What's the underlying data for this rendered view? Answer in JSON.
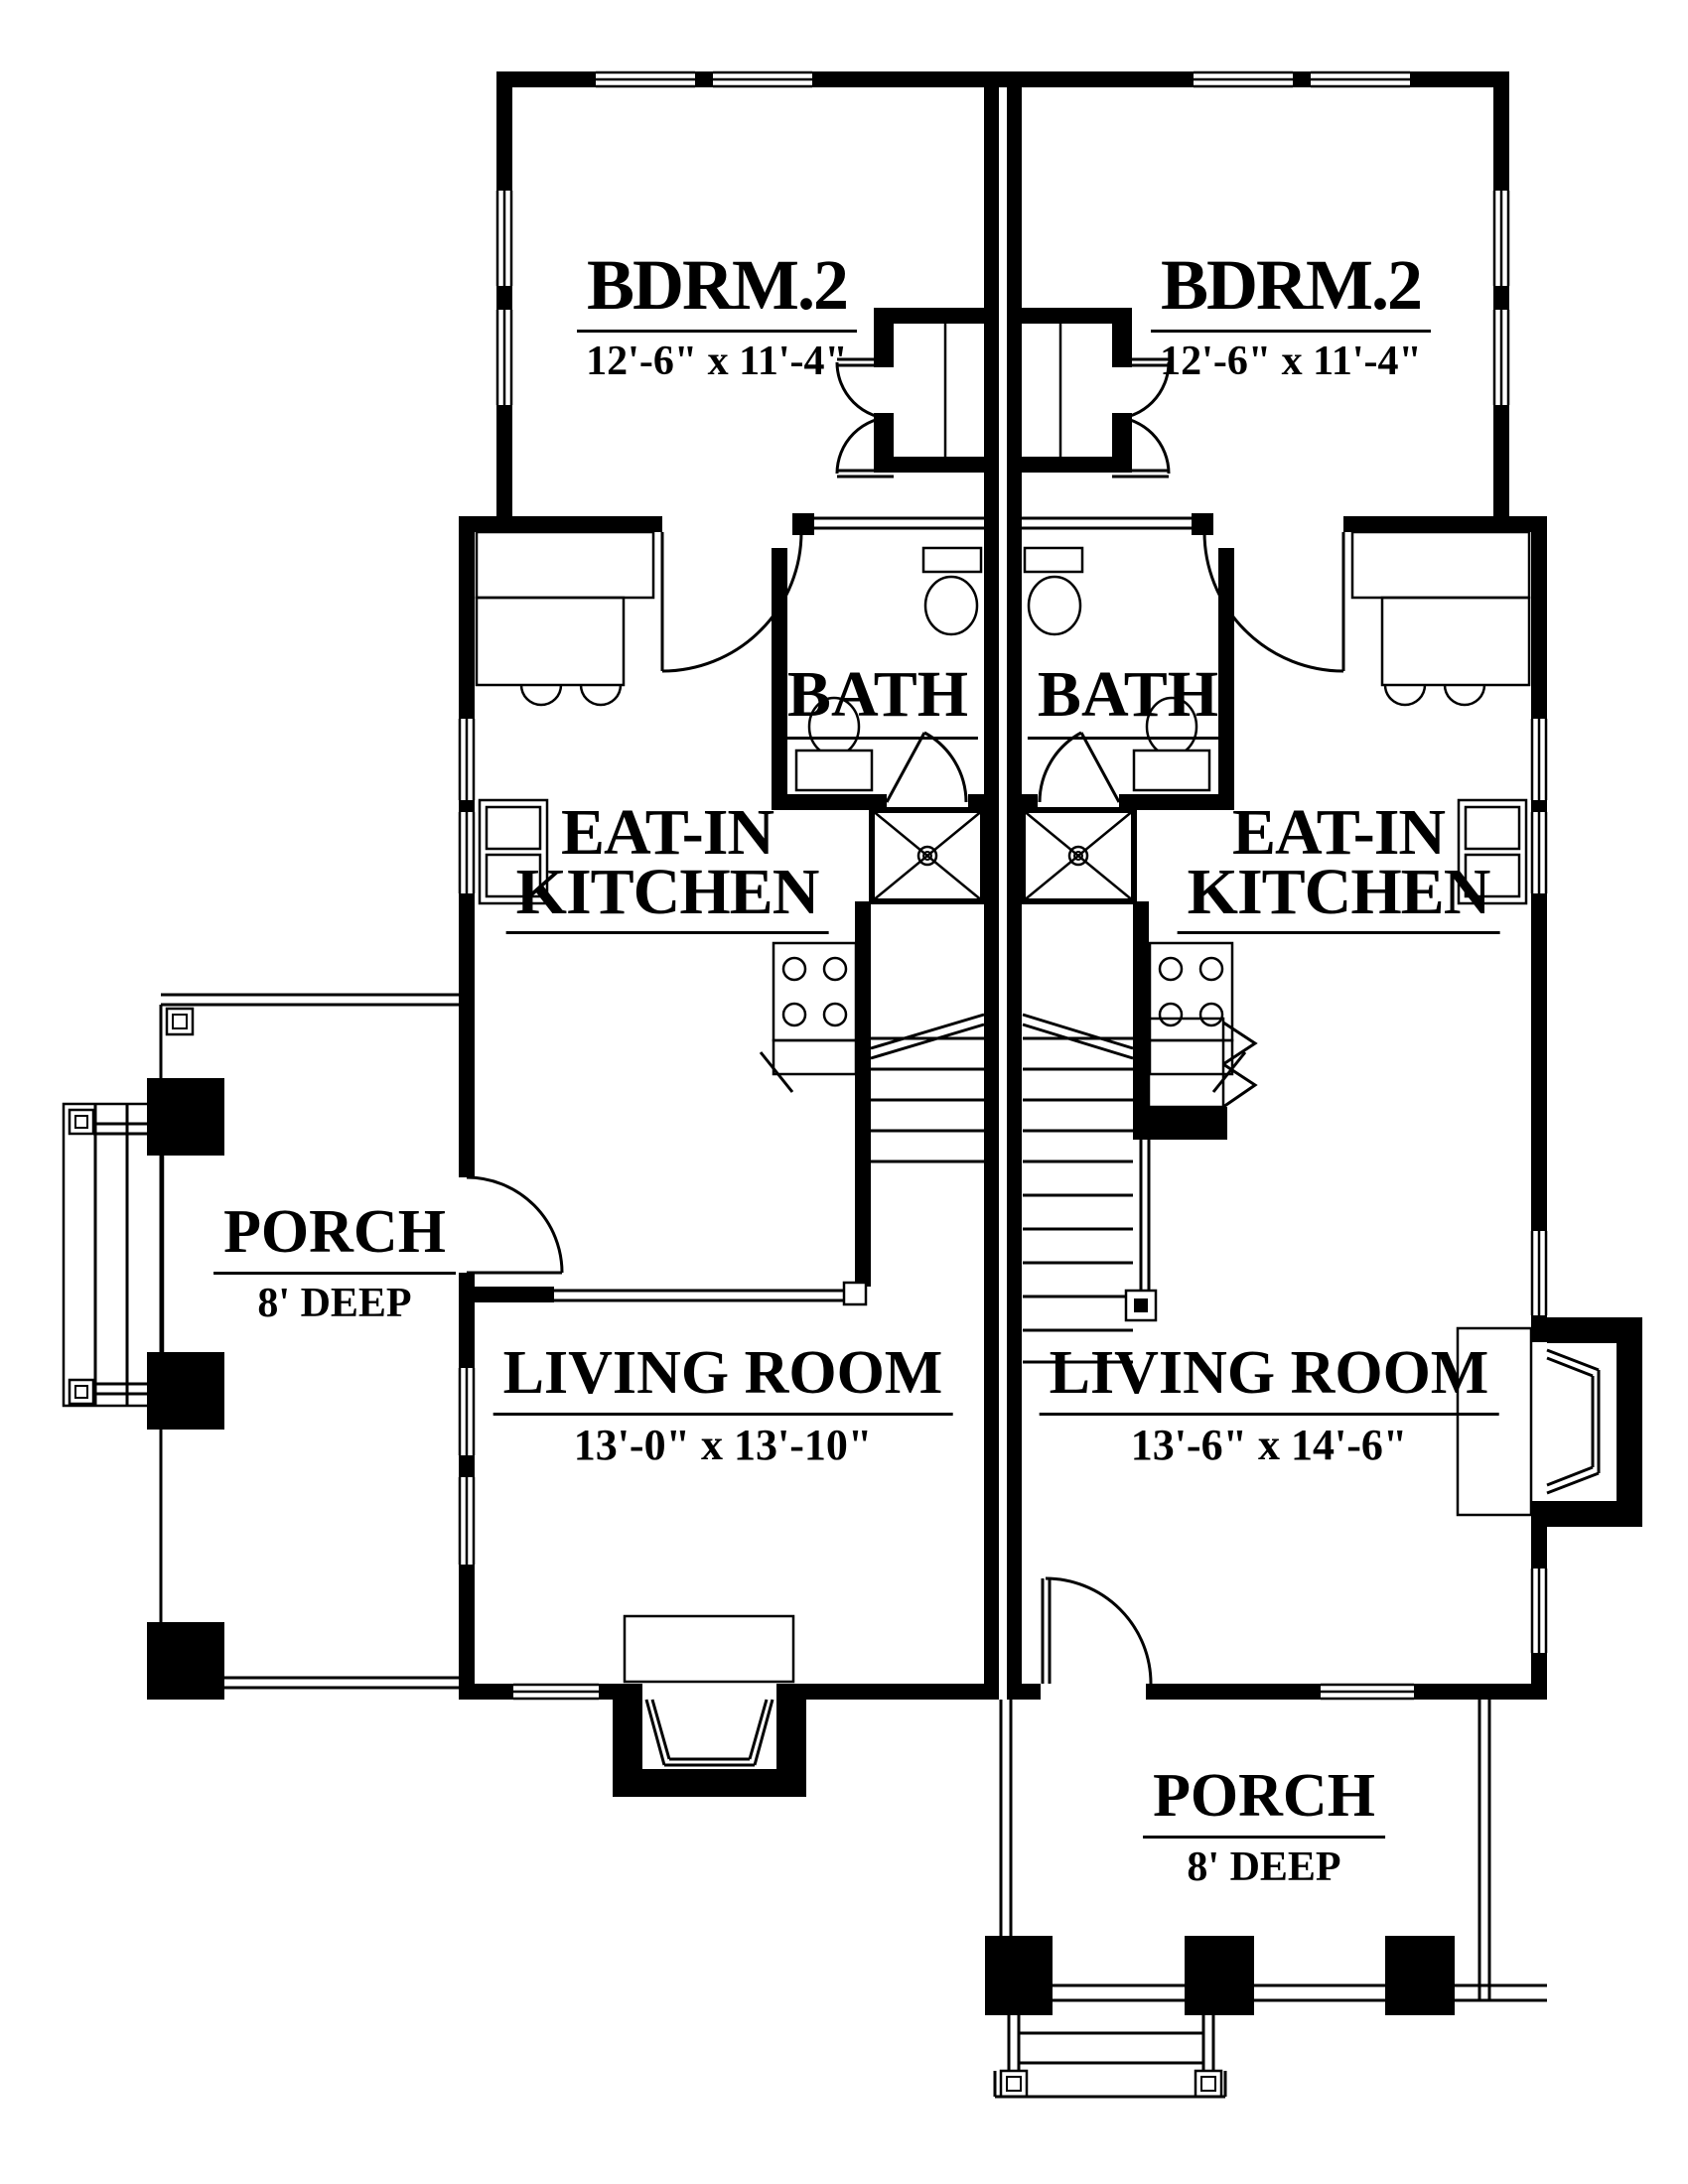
{
  "plan": {
    "background_color": "#ffffff",
    "line_color": "#000000",
    "rooms": [
      {
        "id": "bedroom-left",
        "name": "BDRM.2",
        "dims": "12'-6\" x 11'-4\""
      },
      {
        "id": "bedroom-right",
        "name": "BDRM.2",
        "dims": "12'-6\" x 11'-4\""
      },
      {
        "id": "bath-left",
        "name": "BATH"
      },
      {
        "id": "bath-right",
        "name": "BATH"
      },
      {
        "id": "kitchen-left",
        "name": "EAT-IN",
        "name_line2": "KITCHEN"
      },
      {
        "id": "kitchen-right",
        "name": "EAT-IN",
        "name_line2": "KITCHEN"
      },
      {
        "id": "living-left",
        "name": "LIVING ROOM",
        "dims": "13'-0\" x 13'-10\""
      },
      {
        "id": "living-right",
        "name": "LIVING ROOM",
        "dims": "13'-6\" x 14'-6\""
      },
      {
        "id": "porch-left",
        "name": "PORCH",
        "dims": "8' DEEP"
      },
      {
        "id": "porch-bottom",
        "name": "PORCH",
        "dims": "8' DEEP"
      }
    ]
  }
}
